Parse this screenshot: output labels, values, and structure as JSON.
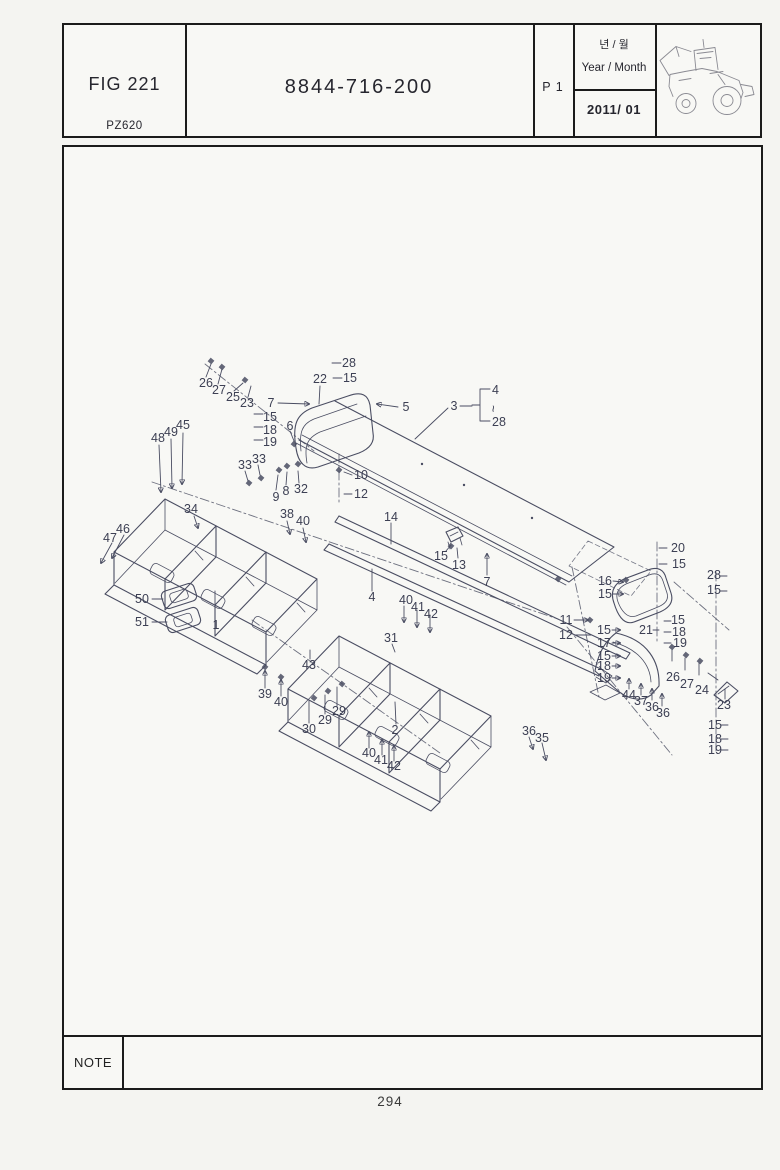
{
  "header": {
    "fig_label": "FIG 221",
    "model_code": "PZ620",
    "part_number": "8844-716-200",
    "page_code": "P 1",
    "year_month_korean": "년 / 월",
    "year_month_english": "Year / Month",
    "year_month_value": "2011/ 01"
  },
  "note": {
    "label": "NOTE"
  },
  "footer": {
    "page_number": "294"
  },
  "colors": {
    "paper": "#f4f4f1",
    "panel_bg": "#f8f8f5",
    "border": "#1b1b1b",
    "line": "#4a4d62",
    "label": "#3d4054",
    "header_text": "#26262e",
    "sketch": "#8a8a92"
  },
  "diagram": {
    "type": "exploded-parts-drawing",
    "callouts": [
      {
        "n": "26",
        "x": 204,
        "y": 381
      },
      {
        "n": "27",
        "x": 217,
        "y": 388
      },
      {
        "n": "25",
        "x": 231,
        "y": 395
      },
      {
        "n": "23",
        "x": 245,
        "y": 401
      },
      {
        "n": "7",
        "x": 269,
        "y": 401
      },
      {
        "n": "15",
        "x": 268,
        "y": 415
      },
      {
        "n": "18",
        "x": 268,
        "y": 428
      },
      {
        "n": "19",
        "x": 268,
        "y": 440
      },
      {
        "n": "6",
        "x": 288,
        "y": 424
      },
      {
        "n": "22",
        "x": 318,
        "y": 377
      },
      {
        "n": "28",
        "x": 347,
        "y": 361
      },
      {
        "n": "15",
        "x": 348,
        "y": 376
      },
      {
        "n": "5",
        "x": 404,
        "y": 405
      },
      {
        "n": "3",
        "x": 452,
        "y": 404
      },
      {
        "n": "4",
        "x": 490,
        "y": 388,
        "a": "s"
      },
      {
        "n": "~",
        "x": 491,
        "y": 403,
        "a": "s",
        "rot": 90
      },
      {
        "n": "28",
        "x": 490,
        "y": 420,
        "a": "s"
      },
      {
        "n": "48",
        "x": 156,
        "y": 436
      },
      {
        "n": "49",
        "x": 169,
        "y": 430
      },
      {
        "n": "45",
        "x": 181,
        "y": 423
      },
      {
        "n": "33",
        "x": 243,
        "y": 463
      },
      {
        "n": "33",
        "x": 257,
        "y": 457
      },
      {
        "n": "9",
        "x": 274,
        "y": 495
      },
      {
        "n": "8",
        "x": 284,
        "y": 489
      },
      {
        "n": "32",
        "x": 299,
        "y": 487
      },
      {
        "n": "10",
        "x": 359,
        "y": 473
      },
      {
        "n": "12",
        "x": 359,
        "y": 492
      },
      {
        "n": "38",
        "x": 285,
        "y": 512
      },
      {
        "n": "40",
        "x": 301,
        "y": 519
      },
      {
        "n": "47",
        "x": 108,
        "y": 536
      },
      {
        "n": "46",
        "x": 121,
        "y": 527
      },
      {
        "n": "34",
        "x": 189,
        "y": 507
      },
      {
        "n": "14",
        "x": 389,
        "y": 515
      },
      {
        "n": "15",
        "x": 439,
        "y": 554
      },
      {
        "n": "13",
        "x": 457,
        "y": 563
      },
      {
        "n": "7",
        "x": 485,
        "y": 580
      },
      {
        "n": "4",
        "x": 370,
        "y": 595
      },
      {
        "n": "50",
        "x": 140,
        "y": 597
      },
      {
        "n": "51",
        "x": 140,
        "y": 620
      },
      {
        "n": "1",
        "x": 214,
        "y": 623
      },
      {
        "n": "40",
        "x": 404,
        "y": 598
      },
      {
        "n": "41",
        "x": 416,
        "y": 605
      },
      {
        "n": "42",
        "x": 429,
        "y": 612
      },
      {
        "n": "31",
        "x": 389,
        "y": 636
      },
      {
        "n": "20",
        "x": 676,
        "y": 546
      },
      {
        "n": "15",
        "x": 677,
        "y": 562
      },
      {
        "n": "16",
        "x": 603,
        "y": 579
      },
      {
        "n": "15",
        "x": 603,
        "y": 592
      },
      {
        "n": "28",
        "x": 712,
        "y": 573
      },
      {
        "n": "15",
        "x": 712,
        "y": 588
      },
      {
        "n": "11",
        "x": 564,
        "y": 618
      },
      {
        "n": "12",
        "x": 564,
        "y": 633
      },
      {
        "n": "15",
        "x": 602,
        "y": 628
      },
      {
        "n": "17",
        "x": 602,
        "y": 641
      },
      {
        "n": "15",
        "x": 602,
        "y": 654
      },
      {
        "n": "18",
        "x": 602,
        "y": 664
      },
      {
        "n": "19",
        "x": 602,
        "y": 676
      },
      {
        "n": "21",
        "x": 644,
        "y": 628
      },
      {
        "n": "15",
        "x": 676,
        "y": 618
      },
      {
        "n": "18",
        "x": 677,
        "y": 630
      },
      {
        "n": "19",
        "x": 678,
        "y": 641
      },
      {
        "n": "26",
        "x": 671,
        "y": 675
      },
      {
        "n": "27",
        "x": 685,
        "y": 682
      },
      {
        "n": "24",
        "x": 700,
        "y": 688
      },
      {
        "n": "44",
        "x": 627,
        "y": 693
      },
      {
        "n": "37",
        "x": 639,
        "y": 699
      },
      {
        "n": "36",
        "x": 650,
        "y": 705
      },
      {
        "n": "36",
        "x": 661,
        "y": 711
      },
      {
        "n": "23",
        "x": 722,
        "y": 703
      },
      {
        "n": "15",
        "x": 713,
        "y": 723
      },
      {
        "n": "18",
        "x": 713,
        "y": 737
      },
      {
        "n": "19",
        "x": 713,
        "y": 748
      },
      {
        "n": "43",
        "x": 307,
        "y": 663
      },
      {
        "n": "39",
        "x": 263,
        "y": 692
      },
      {
        "n": "40",
        "x": 279,
        "y": 700
      },
      {
        "n": "30",
        "x": 307,
        "y": 727
      },
      {
        "n": "29",
        "x": 323,
        "y": 718
      },
      {
        "n": "29",
        "x": 337,
        "y": 709
      },
      {
        "n": "2",
        "x": 393,
        "y": 728
      },
      {
        "n": "40",
        "x": 367,
        "y": 751
      },
      {
        "n": "41",
        "x": 379,
        "y": 758
      },
      {
        "n": "42",
        "x": 392,
        "y": 764
      },
      {
        "n": "36",
        "x": 527,
        "y": 729
      },
      {
        "n": "35",
        "x": 540,
        "y": 736
      }
    ]
  }
}
